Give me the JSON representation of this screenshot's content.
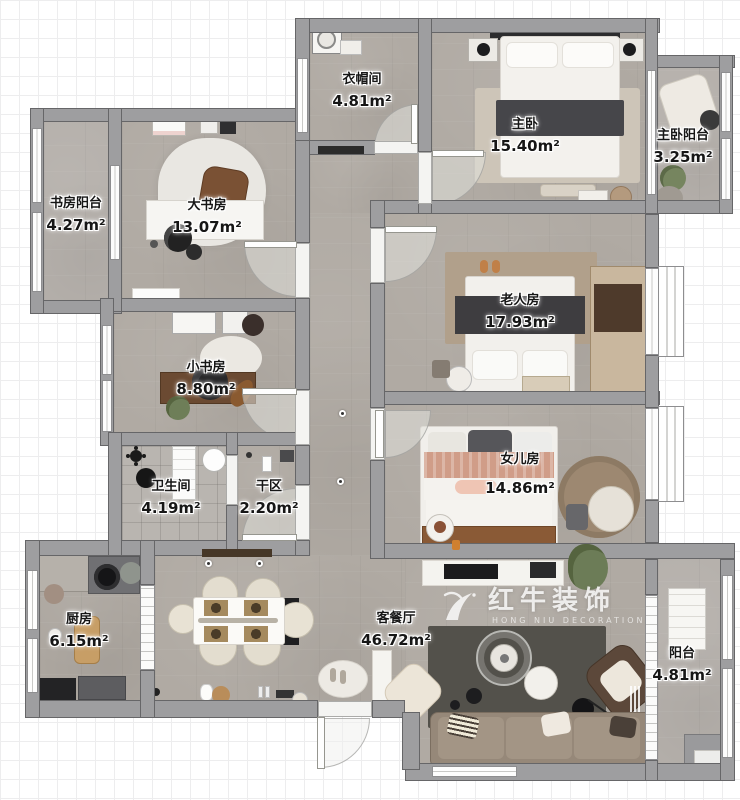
{
  "plan": {
    "rooms": [
      {
        "id": "cloakroom",
        "name": "衣帽间",
        "area": "4.81m²"
      },
      {
        "id": "master-bedroom",
        "name": "主卧",
        "area": "15.40m²"
      },
      {
        "id": "master-balcony",
        "name": "主卧阳台",
        "area": "3.25m²"
      },
      {
        "id": "study-balcony",
        "name": "书房阳台",
        "area": "4.27m²"
      },
      {
        "id": "big-study",
        "name": "大书房",
        "area": "13.07m²"
      },
      {
        "id": "elder-room",
        "name": "老人房",
        "area": "17.93m²"
      },
      {
        "id": "small-study",
        "name": "小书房",
        "area": "8.80m²"
      },
      {
        "id": "bathroom",
        "name": "卫生间",
        "area": "4.19m²"
      },
      {
        "id": "dry-area",
        "name": "干区",
        "area": "2.20m²"
      },
      {
        "id": "daughter-room",
        "name": "女儿房",
        "area": "14.86m²"
      },
      {
        "id": "kitchen",
        "name": "厨房",
        "area": "6.15m²"
      },
      {
        "id": "living-dining",
        "name": "客餐厅",
        "area": "46.72m²"
      },
      {
        "id": "balcony",
        "name": "阳台",
        "area": "4.81m²"
      }
    ],
    "watermark": {
      "brand": "红牛装饰",
      "subtitle": "HONG NIU DECORATION"
    },
    "colors": {
      "wall": "#9e9ea0",
      "floor": "#b0aaa3",
      "wood": "#8a5a36",
      "watermark": "#ffffff"
    }
  }
}
